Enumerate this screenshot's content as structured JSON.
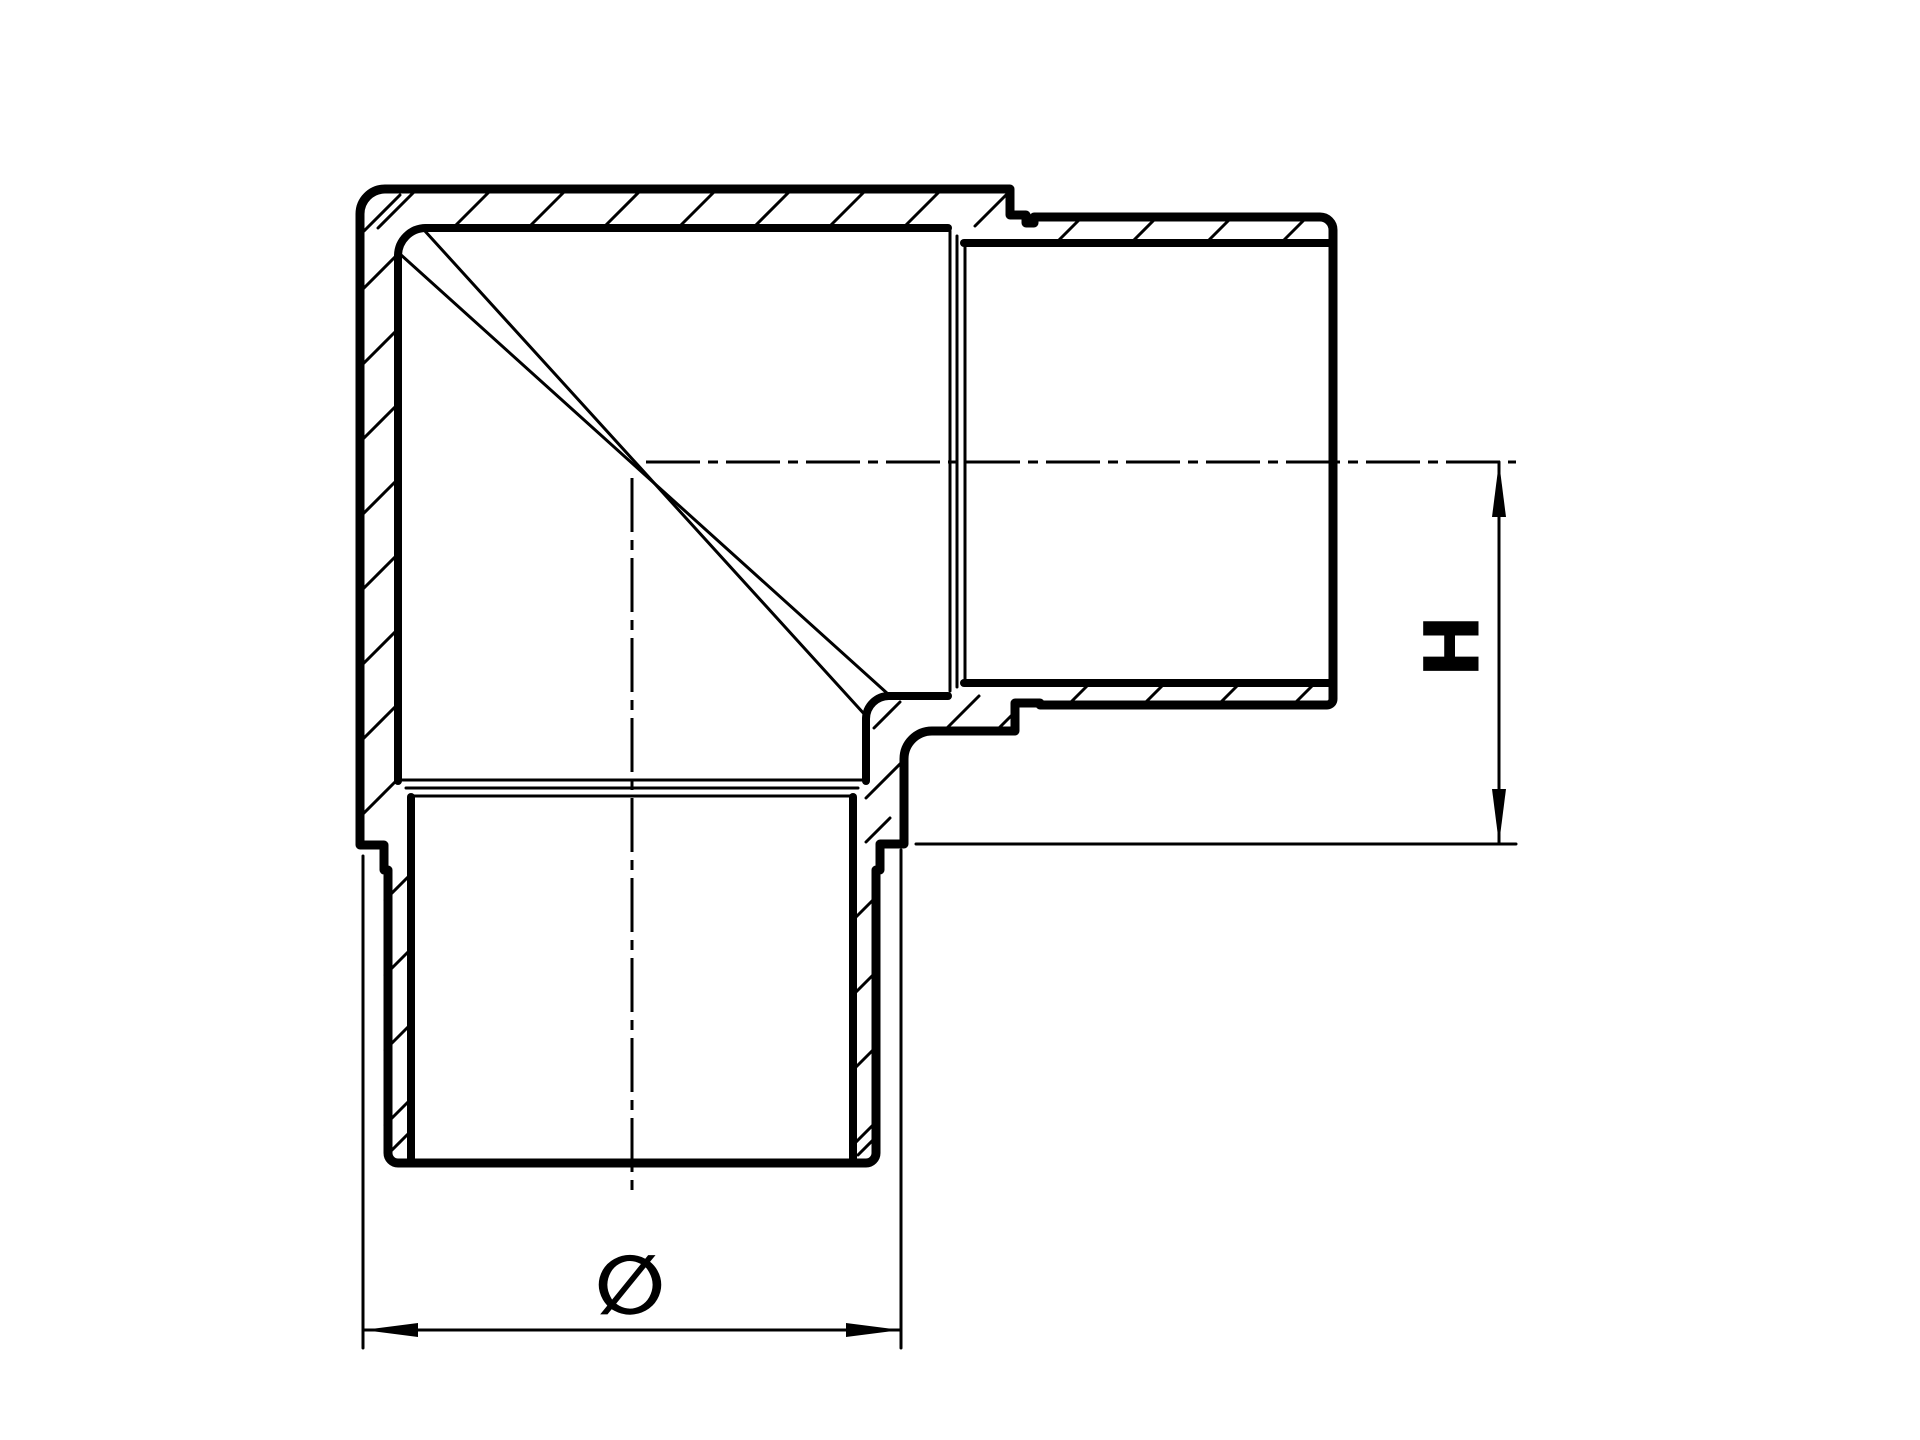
{
  "drawing": {
    "kind": "technical-section-drawing",
    "subject": "90-degree elbow tube fitting, longitudinal section",
    "arms": [
      "horizontal-arm-right",
      "vertical-arm-down"
    ],
    "features": [
      "hatched-wall-sections",
      "miter-seam-lines",
      "stepped-spigot-ends",
      "internal-bore-shoulders",
      "dash-dot-centerlines"
    ]
  },
  "colors": {
    "ink": "#000000",
    "background": "#ffffff"
  },
  "dimensions": {
    "height": {
      "label": "H",
      "orientation": "vertical",
      "from": "horizontal-arm-centerline",
      "to": "vertical-arm-shoulder-plane"
    },
    "diameter": {
      "symbol": "∅",
      "orientation": "horizontal",
      "measures": "body-outer-diameter-of-vertical-arm"
    }
  },
  "line_legend": {
    "thick": "visible section contours",
    "thin": "hatching, internal shoulder edges, miter seam",
    "dash_dot": "centerlines",
    "arrows": "filled dimension arrowheads"
  }
}
